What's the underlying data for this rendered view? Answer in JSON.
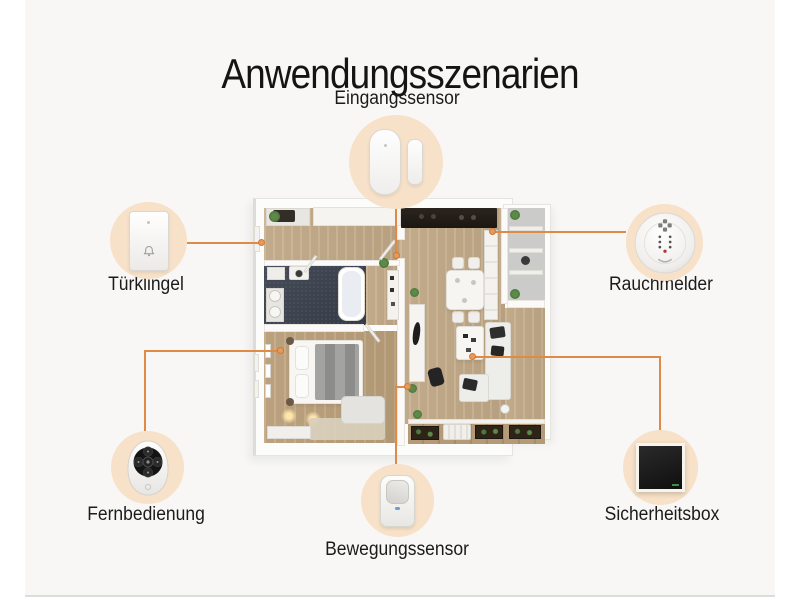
{
  "title": "Anwendungsszenarien",
  "devices": [
    {
      "id": "eingangssensor",
      "label": "Eingangssensor",
      "icon": "door-window-sensor-icon"
    },
    {
      "id": "tuerklingel",
      "label": "Türklingel",
      "icon": "doorbell-icon"
    },
    {
      "id": "rauchmelder",
      "label": "Rauchmelder",
      "icon": "smoke-detector-icon"
    },
    {
      "id": "fernbedienung",
      "label": "Fernbedienung",
      "icon": "remote-control-icon"
    },
    {
      "id": "bewegungssensor",
      "label": "Bewegungssensor",
      "icon": "motion-sensor-icon"
    },
    {
      "id": "sicherheitsbox",
      "label": "Sicherheitsbox",
      "icon": "security-box-icon"
    }
  ],
  "colors": {
    "accent_line": "#e08a45",
    "device_halo": "#f7e1c8",
    "title_text": "#141414",
    "background": "#ffffff",
    "content_background": "#f8f7f6"
  },
  "floorplan": {
    "description": "3D top-down apartment floor plan with kitchen, bathroom, bedroom, living-dining area and balconies"
  }
}
